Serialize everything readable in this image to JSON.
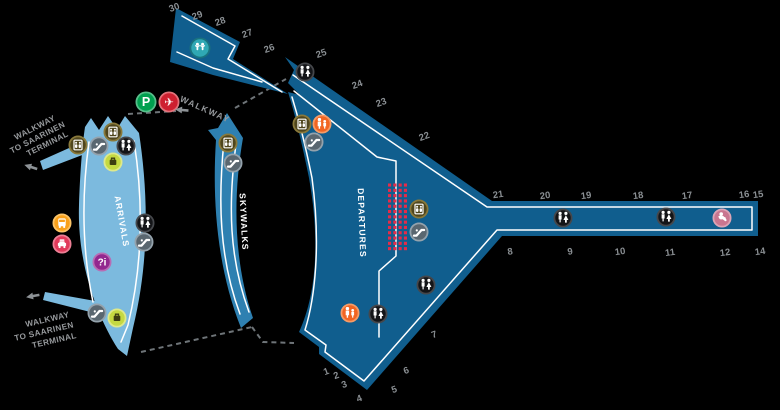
{
  "zones": {
    "arrivals": {
      "label": "ARRIVALS",
      "color": "#7CBADE"
    },
    "skywalks": {
      "label": "SKYWALKS",
      "color": "#2E80B1"
    },
    "departures": {
      "label": "DEPARTURES",
      "color": "#105E8E"
    }
  },
  "walkways": {
    "top_connector_label": "WALKWAY",
    "saarinen_top": {
      "line1": "WALKWAY",
      "line2": "TO SAARINEN",
      "line3": "TERMINAL"
    },
    "saarinen_bottom": {
      "line1": "WALKWAY",
      "line2": "TO SAARINEN",
      "line3": "TERMINAL"
    }
  },
  "colors": {
    "background": "#000000",
    "gate_text": "#8A8F93",
    "walkway_text": "#96999C",
    "dashed_line": "#6E7478",
    "outline": "#FFFFFF"
  },
  "checkpoint_dots": {
    "x": 388,
    "y": 183.5,
    "cols": 4,
    "rows": 13,
    "pitch": 5.3,
    "size": 3.1,
    "color": "#E62B48"
  },
  "gates": [
    {
      "label": "30",
      "x": 174,
      "y": 7,
      "r": -20
    },
    {
      "label": "29",
      "x": 197,
      "y": 15,
      "r": -20
    },
    {
      "label": "28",
      "x": 220,
      "y": 21,
      "r": -20
    },
    {
      "label": "27",
      "x": 247,
      "y": 33,
      "r": -20
    },
    {
      "label": "26",
      "x": 269,
      "y": 48,
      "r": -20
    },
    {
      "label": "25",
      "x": 321,
      "y": 53,
      "r": -20
    },
    {
      "label": "24",
      "x": 357,
      "y": 84,
      "r": -20
    },
    {
      "label": "23",
      "x": 381,
      "y": 102,
      "r": -20
    },
    {
      "label": "22",
      "x": 424,
      "y": 136,
      "r": -20
    },
    {
      "label": "21",
      "x": 498,
      "y": 194,
      "r": -8
    },
    {
      "label": "20",
      "x": 545,
      "y": 195,
      "r": -8
    },
    {
      "label": "19",
      "x": 586,
      "y": 195,
      "r": -8
    },
    {
      "label": "18",
      "x": 638,
      "y": 195,
      "r": -8
    },
    {
      "label": "17",
      "x": 687,
      "y": 195,
      "r": -8
    },
    {
      "label": "16",
      "x": 744,
      "y": 194,
      "r": -8
    },
    {
      "label": "15",
      "x": 758,
      "y": 194,
      "r": -8
    },
    {
      "label": "14",
      "x": 760,
      "y": 251,
      "r": -8
    },
    {
      "label": "12",
      "x": 725,
      "y": 252,
      "r": -8
    },
    {
      "label": "11",
      "x": 670,
      "y": 252,
      "r": -8
    },
    {
      "label": "10",
      "x": 620,
      "y": 251,
      "r": -8
    },
    {
      "label": "9",
      "x": 570,
      "y": 251,
      "r": -8
    },
    {
      "label": "8",
      "x": 510,
      "y": 251,
      "r": -8
    },
    {
      "label": "7",
      "x": 434,
      "y": 334,
      "r": -20
    },
    {
      "label": "6",
      "x": 406,
      "y": 370,
      "r": -20
    },
    {
      "label": "5",
      "x": 394,
      "y": 389,
      "r": -20
    },
    {
      "label": "4",
      "x": 359,
      "y": 398,
      "r": -20
    },
    {
      "label": "3",
      "x": 344,
      "y": 384,
      "r": -20
    },
    {
      "label": "2",
      "x": 336,
      "y": 375,
      "r": -20
    },
    {
      "label": "1",
      "x": 326,
      "y": 371,
      "r": -20
    }
  ],
  "icon_styles": {
    "parking": {
      "fill": "#00A04F",
      "ring": "#57BE8A",
      "r": 10.5
    },
    "flights": {
      "fill": "#CE2030",
      "ring": "#E2737B",
      "r": 10.5
    },
    "play-area": {
      "fill": "#2FA8B4",
      "ring": "#19727F",
      "r": 10.5
    },
    "elevator": {
      "fill": "#4F461D",
      "ring": "#89793B",
      "r": 9.5
    },
    "escalator": {
      "fill": "#5A6770",
      "ring": "#94A2AC",
      "r": 9.5
    },
    "restroom": {
      "fill": "#141518",
      "ring": "#45474B",
      "r": 9.5
    },
    "baggage-claim": {
      "fill": "#C5D941",
      "ring": "#DEE98B",
      "r": 9.5
    },
    "bus": {
      "fill": "#F9A11B",
      "ring": "#FBC468",
      "r": 9.5
    },
    "taxi": {
      "fill": "#E13A5B",
      "ring": "#EC7F95",
      "r": 9.5
    },
    "information": {
      "fill": "#93278F",
      "ring": "#B86CB4",
      "r": 9.5
    },
    "family-restroom": {
      "fill": "#F26522",
      "ring": "#F69B66",
      "r": 9.5
    },
    "nursing-room": {
      "fill": "#C97690",
      "ring": "#DCA4B5",
      "r": 9.5
    },
    "walkway-arrow": {}
  },
  "icons": [
    {
      "type": "parking",
      "x": 146,
      "y": 102
    },
    {
      "type": "flights",
      "x": 169,
      "y": 102
    },
    {
      "type": "play-area",
      "x": 200,
      "y": 48
    },
    {
      "type": "elevator",
      "x": 78,
      "y": 145
    },
    {
      "type": "escalator",
      "x": 99,
      "y": 146
    },
    {
      "type": "elevator",
      "x": 113,
      "y": 132
    },
    {
      "type": "restroom",
      "x": 126,
      "y": 146
    },
    {
      "type": "baggage-claim",
      "x": 113,
      "y": 162
    },
    {
      "type": "bus",
      "x": 62,
      "y": 223
    },
    {
      "type": "taxi",
      "x": 62,
      "y": 244
    },
    {
      "type": "information",
      "x": 102,
      "y": 262
    },
    {
      "type": "restroom",
      "x": 145,
      "y": 223
    },
    {
      "type": "escalator",
      "x": 144,
      "y": 242
    },
    {
      "type": "escalator",
      "x": 97,
      "y": 313
    },
    {
      "type": "baggage-claim",
      "x": 117,
      "y": 318
    },
    {
      "type": "elevator",
      "x": 228,
      "y": 143
    },
    {
      "type": "escalator",
      "x": 233,
      "y": 163
    },
    {
      "type": "restroom",
      "x": 305,
      "y": 72
    },
    {
      "type": "elevator",
      "x": 302,
      "y": 124
    },
    {
      "type": "family-restroom",
      "x": 322,
      "y": 124
    },
    {
      "type": "escalator",
      "x": 314,
      "y": 142
    },
    {
      "type": "elevator",
      "x": 419,
      "y": 209
    },
    {
      "type": "escalator",
      "x": 419,
      "y": 232
    },
    {
      "type": "restroom",
      "x": 426,
      "y": 285
    },
    {
      "type": "family-restroom",
      "x": 350,
      "y": 313
    },
    {
      "type": "restroom",
      "x": 378,
      "y": 314
    },
    {
      "type": "restroom",
      "x": 563,
      "y": 218
    },
    {
      "type": "restroom",
      "x": 666,
      "y": 217
    },
    {
      "type": "nursing-room",
      "x": 722,
      "y": 218
    },
    {
      "type": "walkway-arrow",
      "x": 31,
      "y": 167,
      "r": 18
    },
    {
      "type": "walkway-arrow",
      "x": 33,
      "y": 296,
      "r": -10
    },
    {
      "type": "walkway-arrow",
      "x": 182,
      "y": 110,
      "r": 5
    }
  ]
}
